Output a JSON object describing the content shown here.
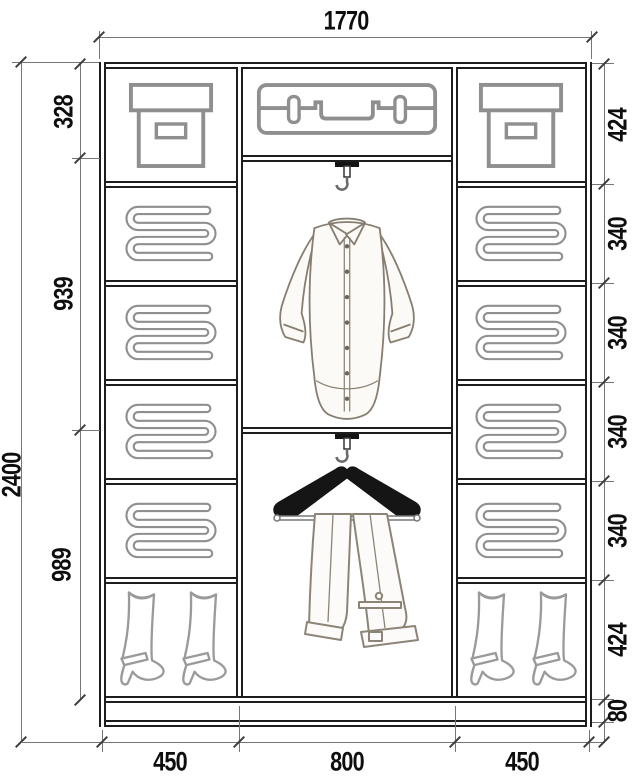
{
  "dimensions": {
    "overall_width": "1770",
    "overall_height": "2400",
    "center_sections": [
      "328",
      "939",
      "989"
    ],
    "right_sections": [
      "424",
      "340",
      "340",
      "340",
      "340",
      "424",
      "80"
    ],
    "bottom_widths": [
      "450",
      "800",
      "450"
    ]
  },
  "icons": {
    "left_column": [
      "storage-box-icon",
      "folded-clothes-icon",
      "folded-clothes-icon",
      "folded-clothes-icon",
      "folded-clothes-icon",
      "boots-icon"
    ],
    "center_column": [
      "suitcase-icon",
      "rod-hook-icon",
      "shirt-icon",
      "rod-hook-icon",
      "trousers-on-hanger-icon"
    ],
    "right_column": [
      "storage-box-icon",
      "folded-clothes-icon",
      "folded-clothes-icon",
      "folded-clothes-icon",
      "folded-clothes-icon",
      "boots-icon"
    ]
  },
  "colors": {
    "background": "#ffffff",
    "structure_line": "#1d1d1d",
    "icon_line": "#8f8f8f",
    "sketch_line": "#877e71",
    "dimension_line": "#767676",
    "tick": "#3c3c3c",
    "text": "#0e0e0e",
    "hanger": "#151515"
  }
}
